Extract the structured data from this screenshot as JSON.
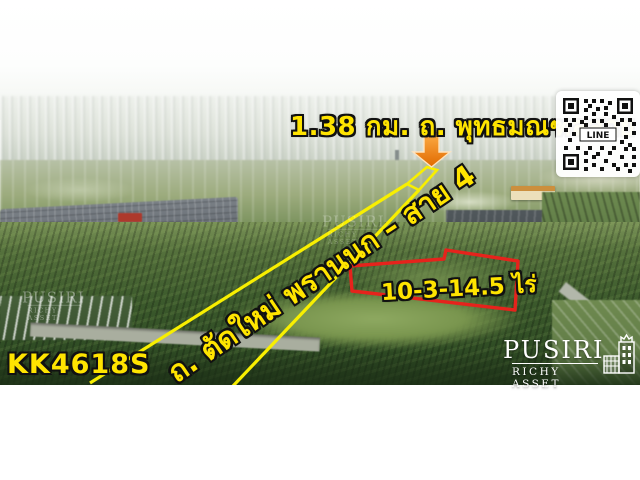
{
  "labels": {
    "distance": "1.38 กม. ถ. พุทธมณฑลสาย 4",
    "road": "ถ. ตัดใหม่ พรานนก – สาย 4",
    "area": "10-3-14.5 ไร่",
    "code": "KK4618S"
  },
  "qr": {
    "service": "LINE"
  },
  "brand": {
    "name": "PUSIRI",
    "tagline": "RICHY ASSET"
  },
  "colors": {
    "label_yellow": "#ffe400",
    "line_yellow": "#f8ef00",
    "boundary_red": "#e6231c",
    "arrow_orange": "#f28418"
  }
}
